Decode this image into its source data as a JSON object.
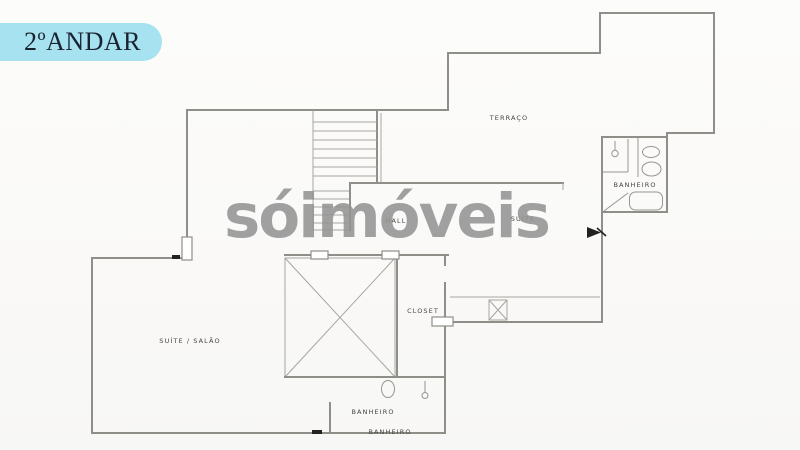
{
  "floor_badge": {
    "label": "2ºANDAR",
    "background": "#a6e2f0",
    "text_color": "#1a2430"
  },
  "watermark": {
    "text": "sóimóveis",
    "color": "#949494"
  },
  "plan": {
    "line_color": "#8f8e89",
    "thin_line_color": "#a6a5a0",
    "label_color": "#45443f",
    "paper_color": "#fafaf8",
    "labels": {
      "terraco": "TERRAÇO",
      "banheiro_suite": "BANHEIRO",
      "hall": "HALL",
      "suite": "SUÍTE",
      "suite_salao": "SUÍTE / SALÃO",
      "closet": "CLOSET",
      "banheiro_inferior": "BANHEIRO",
      "banheiro_borda": "BANHEIRO"
    }
  }
}
